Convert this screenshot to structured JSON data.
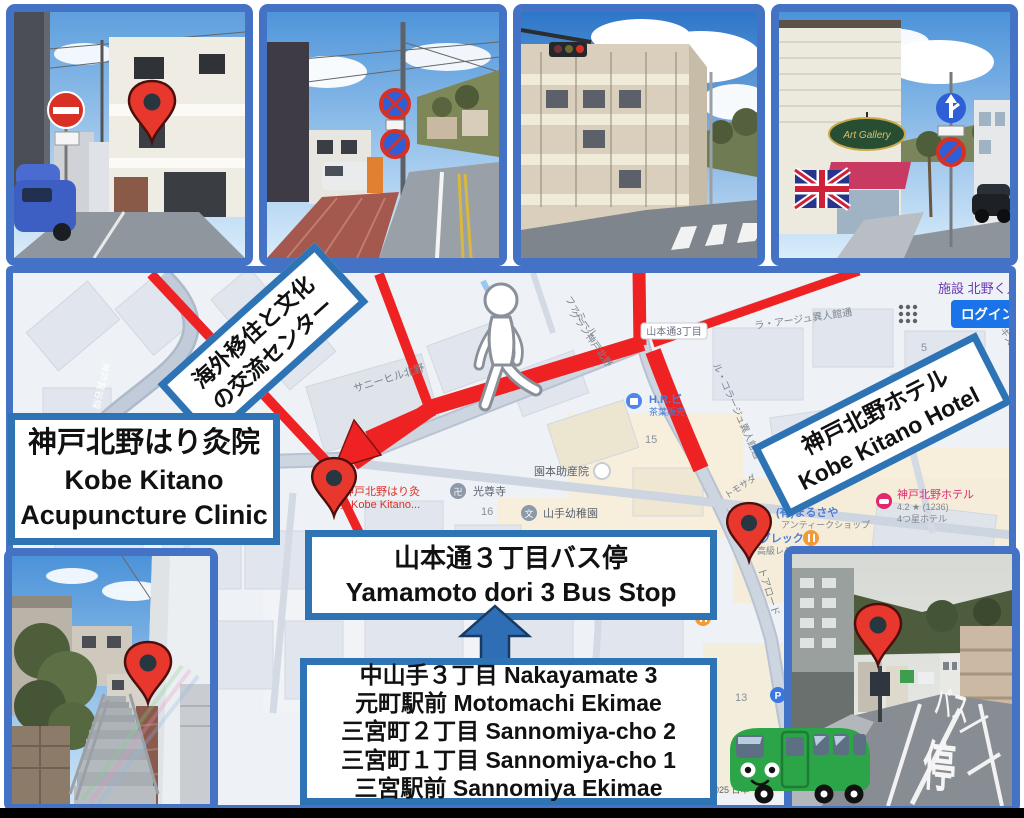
{
  "boxes": {
    "clinic": {
      "line1": "神戸北野はり灸院",
      "line2": "Kobe Kitano",
      "line3": "Acupuncture Clinic"
    },
    "exchange_center": {
      "line1": "海外移住と文化",
      "line2": "の交流センター"
    },
    "hotel": {
      "line1": "神戸北野ホテル",
      "line2": "Kobe Kitano Hotel"
    },
    "bus_stop": {
      "line1": "山本通３丁目バス停",
      "line2": "Yamamoto dori 3 Bus Stop"
    },
    "stops": {
      "lines": [
        "中山手３丁目 Nakayamate 3",
        "元町駅前 Motomachi Ekimae",
        "三宮町２丁目 Sannomiya-cho 2",
        "三宮町１丁目 Sannomiya-cho 1",
        "三宮駅前 Sannomiya Ekimae"
      ]
    }
  },
  "map": {
    "chrome": {
      "search_text": "施設 北野く入",
      "login": "ログイン"
    },
    "road_sign": "山本通3丁目",
    "road_labels": {
      "kobe_minotani": "神戸箕谷線",
      "sunny_hill": "サニーヒル北野",
      "famille1": "ファミール",
      "famille2": "グラン神戸北野",
      "le_collage": "ル・コラージュ異人館通",
      "la_age": "ラ・アージュ異人館通",
      "tor_road": "トアロード",
      "tomosada": "トモサダ",
      "hakisuri": "ハーキスリー"
    },
    "pois": {
      "hr_name": "H.R.ビ",
      "hr_sub": "茶葉販売",
      "midwife": "園本助産院",
      "temple": "光尊寺",
      "kindergarten": "山手幼稚園",
      "clinic1": "神戸北野はり灸",
      "clinic2": "院 Kobe Kitano...",
      "marusaya": "(有)まるさや",
      "marusaya_sub": "アンティークショップ",
      "ygrec": "イグレック",
      "ygrec_sub": "高級レストラン",
      "hotel": "神戸北野ホテル",
      "hotel_rating": "4.2 ★ (1236)",
      "hotel_sub": "4つ星ホテル",
      "parking": "P"
    },
    "blocks": {
      "b5": "5",
      "b13": "13",
      "b15": "15",
      "b16": "16"
    },
    "attribution": "2025 日本"
  },
  "photos": {
    "art_gallery_sign": "Art Gallery",
    "road_paint_ba": "バス",
    "road_paint_tei": "停"
  }
}
